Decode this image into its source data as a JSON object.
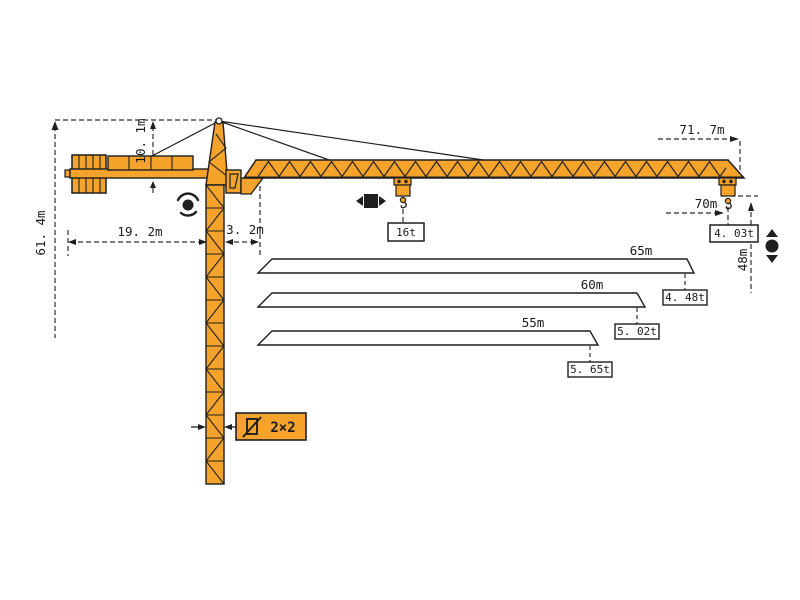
{
  "diagram": {
    "kind": "tower-crane-working-range-diagram",
    "colors": {
      "crane_orange": "#F5A32B",
      "outline": "#1f1f1f",
      "dimension_line": "#2e2e2e",
      "background": "#ffffff"
    },
    "labels": {
      "total_height": "61. 4m",
      "tower_head_height": "10. 1m",
      "counter_jib_radius": "19. 2m",
      "jib_root_offset": "3. 2m",
      "jib_overall_length": "71. 7m",
      "max_working_radius": "70m",
      "tip_load_at_70m": "4. 03t",
      "lifting_height": "48m",
      "max_lifting_capacity": "16t",
      "mast_section_size": "2×2"
    },
    "jib_options": [
      {
        "length": "65m",
        "tip_load": "4. 48t"
      },
      {
        "length": "60m",
        "tip_load": "5. 02t"
      },
      {
        "length": "55m",
        "tip_load": "5. 65t"
      }
    ],
    "icons": {
      "slewing": "rotation-dot-with-arcs",
      "trolley_travel": "left-right-arrows-square",
      "hoisting": "up-down-arrows-dot",
      "mast_section": "square-cross-section-slash"
    }
  }
}
